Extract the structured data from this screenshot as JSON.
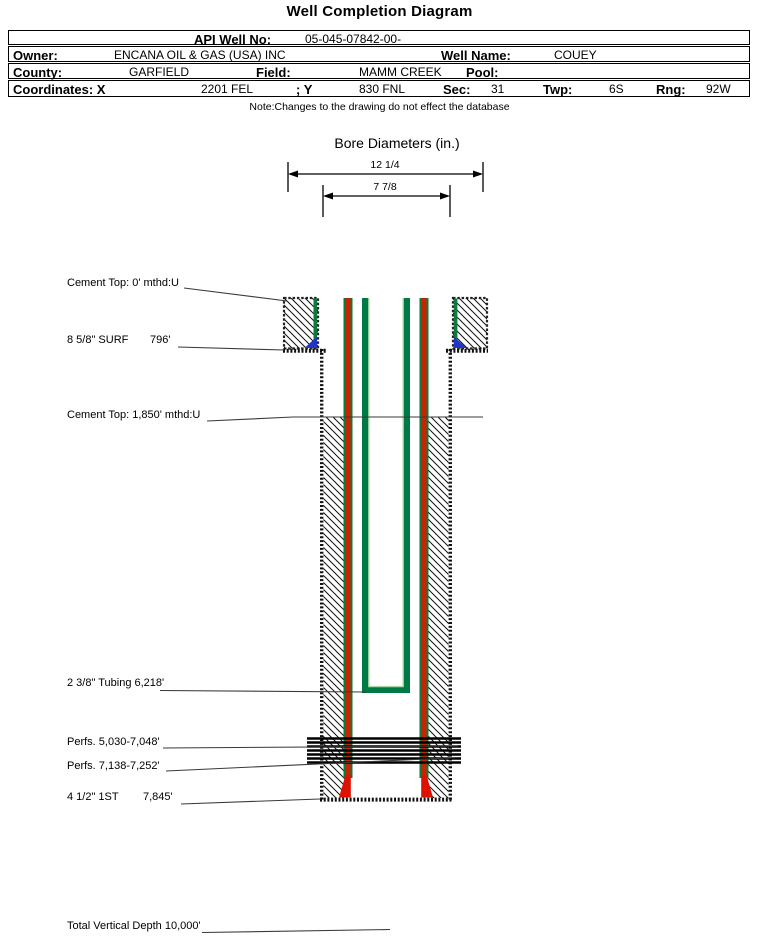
{
  "title": "Well Completion Diagram",
  "header": {
    "api_label": "API Well No:",
    "api_value": "05-045-07842-00-",
    "owner_label": "Owner:",
    "owner_value": "ENCANA OIL & GAS (USA) INC",
    "well_name_label": "Well Name:",
    "well_name_value": "COUEY",
    "county_label": "County:",
    "county_value": "GARFIELD",
    "field_label": "Field:",
    "field_value": "MAMM CREEK",
    "pool_label": "Pool:",
    "pool_value": "",
    "coords_label": "Coordinates: X",
    "coord_x_value": "2201 FEL",
    "coord_y_label": "; Y",
    "coord_y_value": "830 FNL",
    "sec_label": "Sec:",
    "sec_value": "31",
    "twp_label": "Twp:",
    "twp_value": "6S",
    "rng_label": "Rng:",
    "rng_value": "92W"
  },
  "note": "Note:Changes to the drawing do not effect the database",
  "bore_diameters": {
    "title": "Bore Diameters (in.)",
    "outer": "12 1/4",
    "inner": "7 7/8"
  },
  "annotations": {
    "cement_top_surface": "Cement Top: 0' mthd:U",
    "surface_casing": "8 5/8\" SURF",
    "surface_casing_depth": "796'",
    "cement_top_production": "Cement Top: 1,850' mthd:U",
    "tubing": "2 3/8\" Tubing 6,218'",
    "perfs_upper": "Perfs. 5,030-7,048'",
    "perfs_lower": "Perfs. 7,138-7,252'",
    "production_casing": "4 1/2\" 1ST",
    "production_casing_depth": "7,845'",
    "total_vertical_depth": "Total Vertical Depth 10,000'"
  },
  "colors": {
    "casing_red": "#cc2200",
    "cement_green": "#0b7a3c",
    "tubing_green": "#007a45",
    "tubing_highlight": "#a8d8a8",
    "shoe_blue": "#2233cc",
    "shoe_red": "#dd1100"
  }
}
